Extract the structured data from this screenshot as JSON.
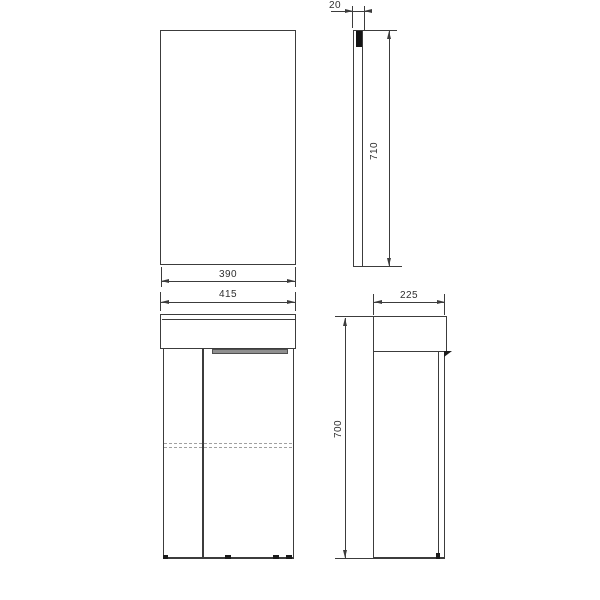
{
  "colors": {
    "bg": "#ffffff",
    "line": "#3c3c3c",
    "line-strong": "#1a1a1a",
    "handle": "#8f8f8f",
    "dash": "#a0a0a0",
    "glass": "#141414"
  },
  "dimensions": {
    "mirror_width": "390",
    "cabinet_width": "415",
    "mirror_depth": "20",
    "mirror_height": "710",
    "cabinet_depth": "225",
    "cabinet_height": "700"
  }
}
